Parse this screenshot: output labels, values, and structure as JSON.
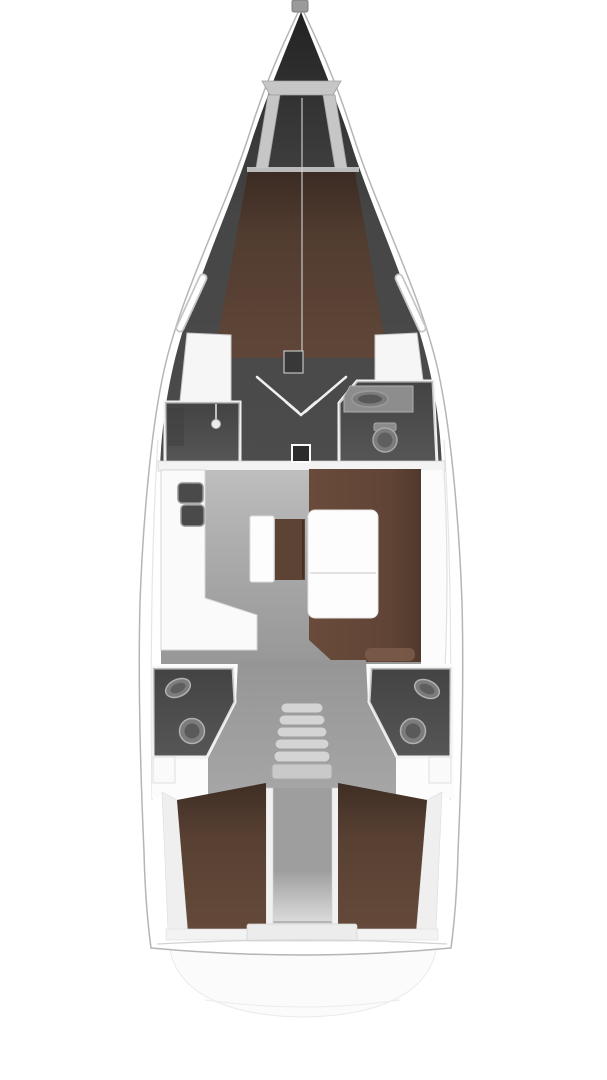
{
  "plan": {
    "subject": "sailing-yacht interior floor plan, top-down view, bow up",
    "areas": [
      {
        "id": "anchor-locker",
        "label": "anchor locker"
      },
      {
        "id": "forward-cabin",
        "label": "forward cabin with V-berth"
      },
      {
        "id": "forward-shower",
        "label": "forward shower compartment"
      },
      {
        "id": "forward-head",
        "label": "forward head with sink and toilet"
      },
      {
        "id": "mast",
        "label": "mast step"
      },
      {
        "id": "galley",
        "label": "L-shaped galley with twin sinks"
      },
      {
        "id": "chart-seat",
        "label": "chart seat and locker island"
      },
      {
        "id": "salon-dinette",
        "label": "salon dinette with folding table"
      },
      {
        "id": "companionway",
        "label": "companionway steps"
      },
      {
        "id": "aft-head-port",
        "label": "port aft head with sink and toilet"
      },
      {
        "id": "aft-head-starboard",
        "label": "starboard aft head with sink and toilet"
      },
      {
        "id": "aft-cabin-port",
        "label": "port aft cabin double berth"
      },
      {
        "id": "aft-cabin-starboard",
        "label": "starboard aft cabin double berth"
      },
      {
        "id": "engine-walkway",
        "label": "center walkway / engine box"
      },
      {
        "id": "transom",
        "label": "transom and swim platform"
      }
    ]
  },
  "colors": {
    "page_background": "#ffffff",
    "deck_white": "#ffffff",
    "wall_white": "#f3f3f3",
    "hull_line": "#b5b5b5",
    "interior_dark": "#4c4c4c",
    "head_gray": "#565656",
    "vberth_brown": "#5f4638",
    "aft_berth_brown": "#654a3a",
    "settee_brown": "#6a4b3b",
    "island_brown": "#5d4334",
    "table_white": "#fdfdfd",
    "galley_white": "#fafafa",
    "floor_light": "#b0b0b0",
    "floor_mid": "#a6a6a6",
    "walkway_gray": "#9e9e9e",
    "fixture_gray": "#7c7c7c",
    "fixture_outline": "#b0b0b0",
    "appliance_dark": "#4a4a4a",
    "steps_gray": "#d4d4d4",
    "locker_gray": "#c6c6c6",
    "mast_dark": "#2c2c2c"
  }
}
